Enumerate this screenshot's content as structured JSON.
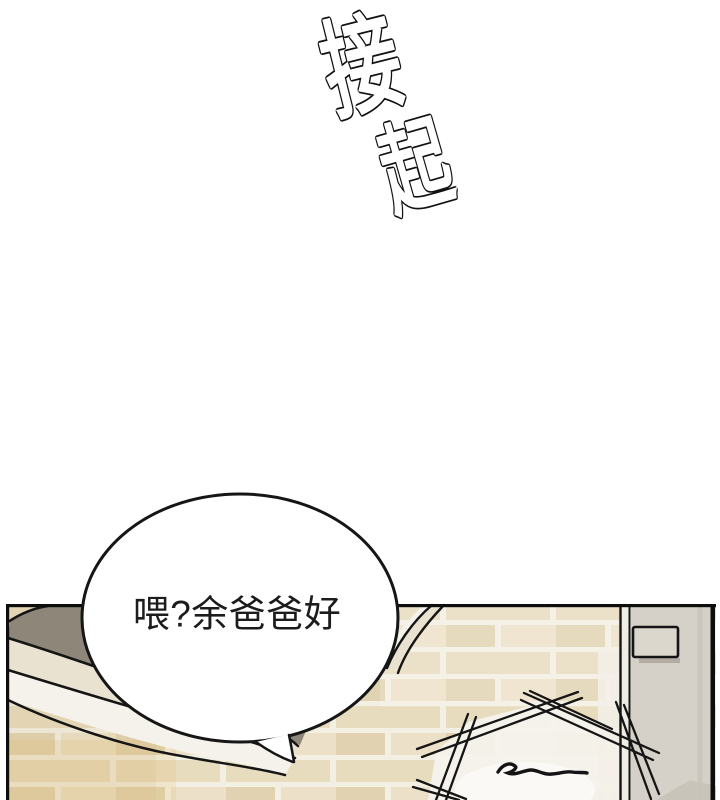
{
  "sound_effect": {
    "char_1": "接",
    "char_2": "起"
  },
  "dialogue": {
    "bubble_text": "喂?余爸爸好"
  },
  "colors": {
    "page_bg": "#ffffff",
    "line": "#151515",
    "mortar": "#f3efe3",
    "brick_base": "#e8dcbf",
    "brick_dark": "#e1d3b1",
    "brick_light": "#ece1c8",
    "shadow_gray": "#8d8679",
    "band_cream": "#e9e2d1",
    "band_white": "#f4f2ea",
    "door_gap": "#efece4",
    "door_face": "#d6d1c8",
    "handle": "#dcd7cd",
    "corner_shadow": "#c8c2b7",
    "white_patch": "#f4f2ec",
    "bubble_fill": "#ffffff",
    "text": "#1c1c1c"
  }
}
